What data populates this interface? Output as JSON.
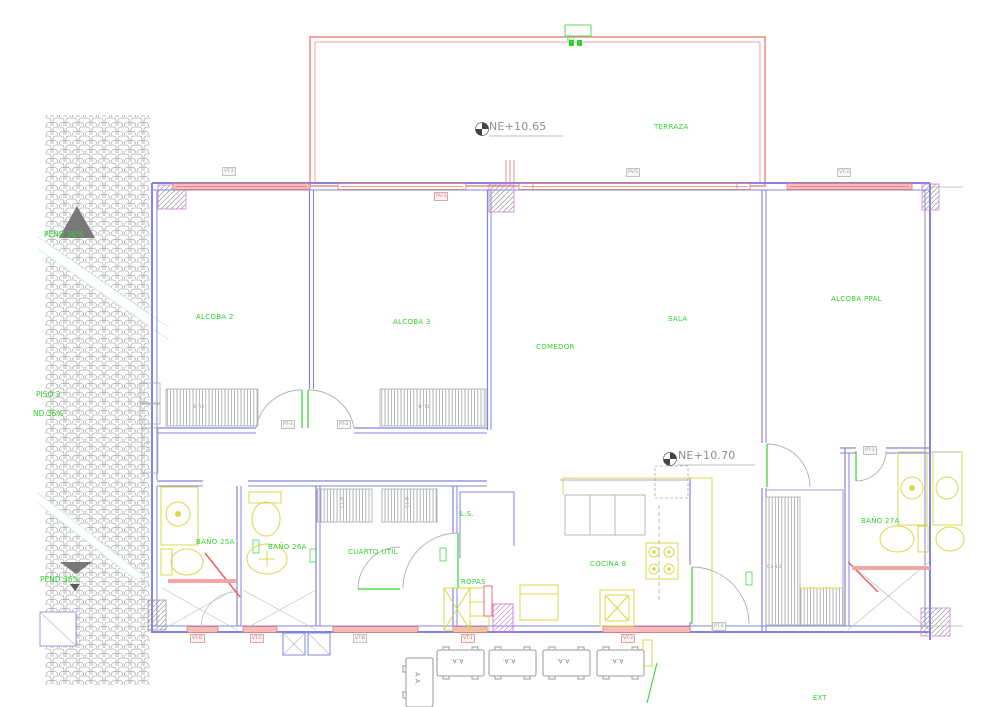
{
  "rooms": {
    "terraza": "TERRAZA",
    "alcoba2": "ALCOBA 2",
    "alcoba3": "ALCOBA 3",
    "sala": "SALA",
    "comedor": "COMEDOR",
    "alcoba_ppal": "ALCOBA PPAL",
    "bano_25a": "BAÑO 25A",
    "bano_26a": "BAÑO 26A",
    "cuarto_util": "CUARTO UTIL",
    "ls": "L.S.",
    "ropas": "ROPAS",
    "cocina_8": "COCINA 8",
    "bano_27a": "BAÑO 27A"
  },
  "levels": {
    "ne_terrace": "NE+10.65",
    "ne_floor": "NE+10.70"
  },
  "roof": {
    "pend_top": "PEND 36%",
    "piso_2": "PISO 2",
    "pend_mid": "ND 36%",
    "pend_low": "PEND 36%"
  },
  "tags": {
    "vt_2": "VT-2",
    "pv_3": "PV-3",
    "pv_5": "PV-5",
    "vt_3": "VT-3",
    "pt_3": "PT-3",
    "pt_2": "PT-2",
    "pt_1": "PT-1",
    "vt_d": "VT-D",
    "vt_c": "VT-C",
    "vt_b": "VT-B",
    "vt_1": "VT-1",
    "b_1": "B-1"
  },
  "closets": {
    "cl_b": "CL-B",
    "cl_13": "CL-13"
  },
  "equipment": {
    "ac": "A.A."
  },
  "exterior": {
    "ext": "EXT"
  },
  "colors": {
    "wall": "#8484de",
    "window_line": "#e07878",
    "window_fill": "#f6bcbc",
    "terrace": "#f2a6a6",
    "label_green": "#2fd32f",
    "fixture_yellow": "#d8d84a",
    "hatch_gray": "#a8a8a8",
    "column_magenta": "#cf7fcf",
    "level_gray": "#8f8f8f"
  }
}
